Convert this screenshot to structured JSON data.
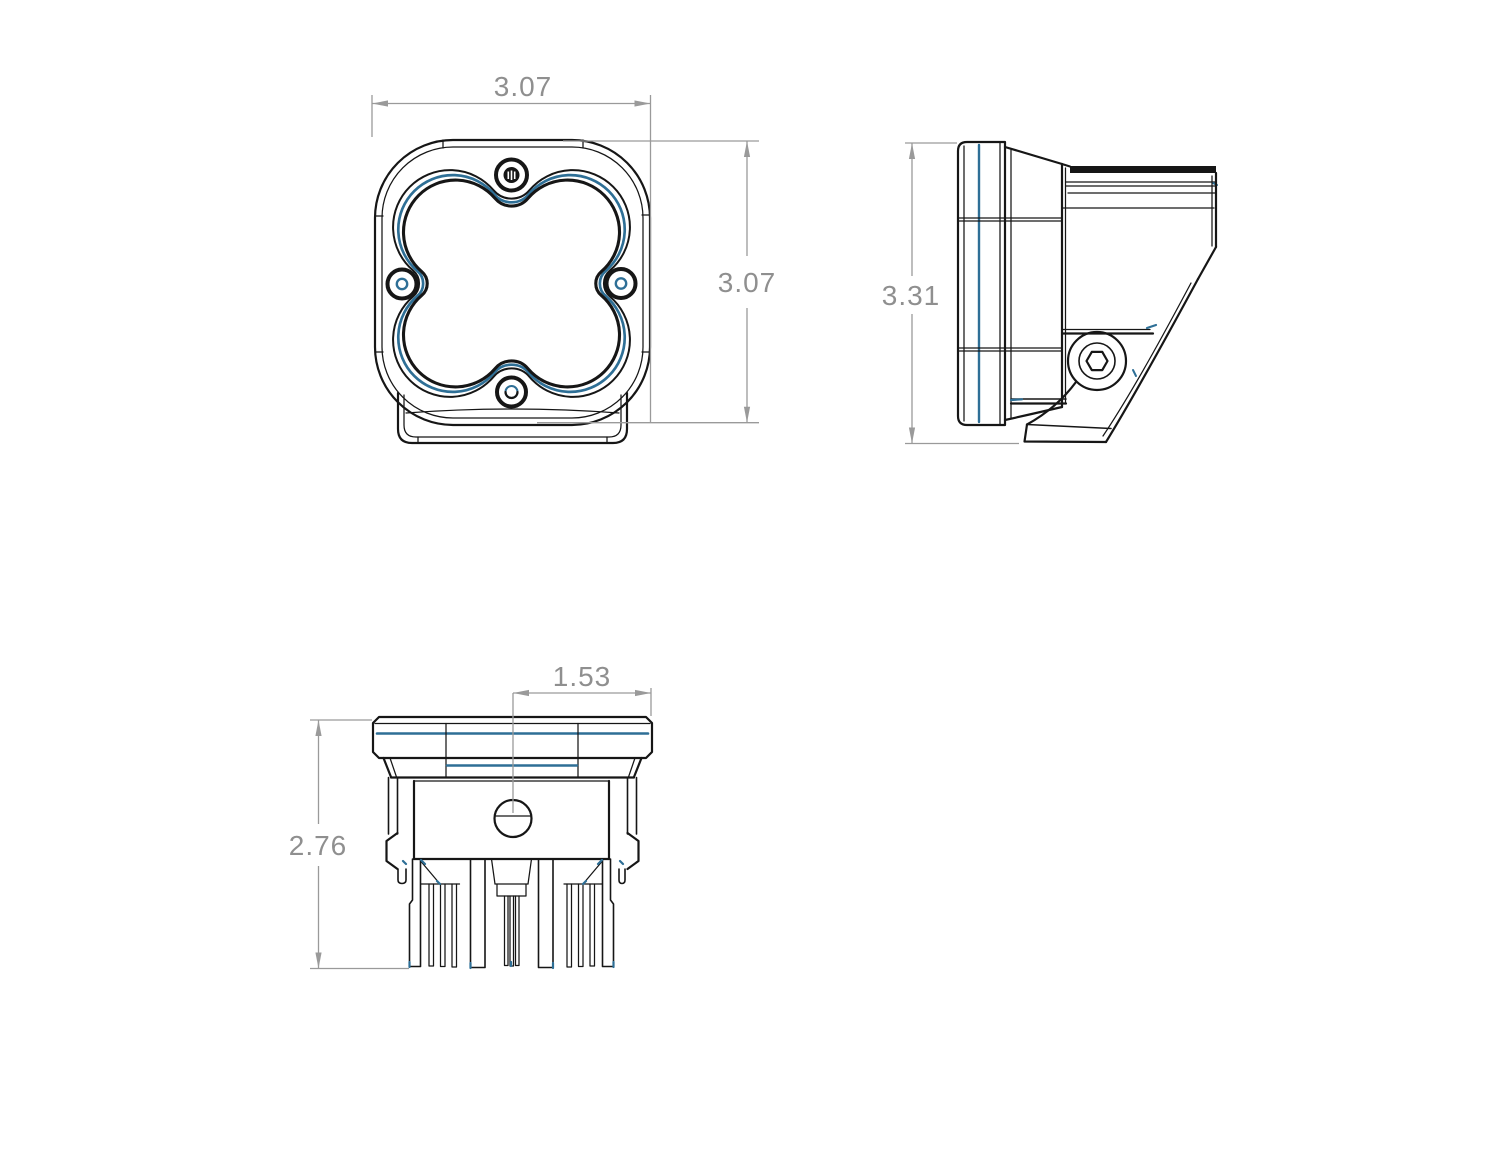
{
  "drawing": {
    "kind": "technical-dimension-drawing",
    "subject": "square LED pod light, three orthographic views",
    "colors": {
      "outline": "#161616",
      "accent_blue": "#2e6f96",
      "dimension_gray": "#9a9a9a",
      "dimension_text_gray": "#8f8f8f",
      "background": "#ffffff"
    },
    "dimensions": {
      "front_width": "3.07",
      "front_height": "3.07",
      "side_height": "3.31",
      "bottom_height": "2.76",
      "bottom_center_to_edge": "1.53"
    }
  }
}
